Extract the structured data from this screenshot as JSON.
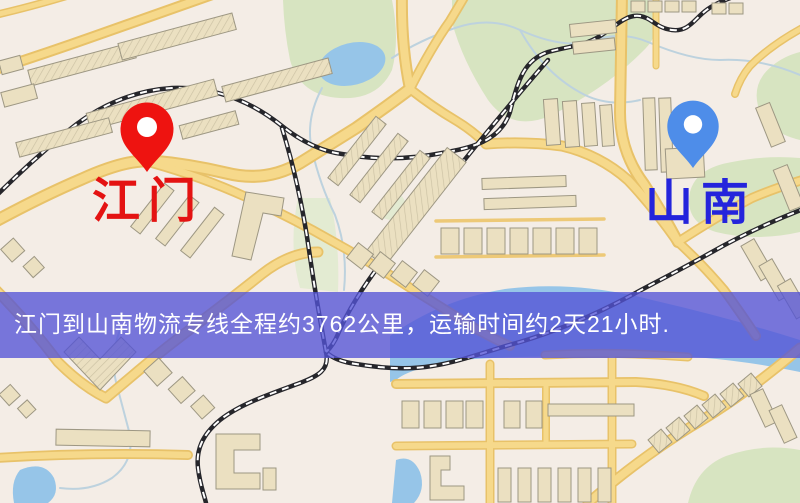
{
  "map": {
    "origin": {
      "label": "江门"
    },
    "destination": {
      "label": "山南"
    },
    "banner": {
      "text": "江门到山南物流专线全程约3762公里，运输时间约2天21小时."
    },
    "colors": {
      "bg": "#f4ede6",
      "road_fill": "#f6d98b",
      "road_casing": "#e8c269",
      "road_thin": "#edc977",
      "bldg_fill": "#ebe0c1",
      "bldg_stroke": "#9d9783",
      "park": "#d7e4c1",
      "park_soft": "#e3ebd2",
      "water": "#96c5e8",
      "stream": "#bdd2de",
      "rail": "#26262b",
      "rail_dash": "#ffffff",
      "banner_bg": "#5353d6",
      "banner_text": "#ffffff",
      "pin_red": "#ee1310",
      "label_red": "#e41312",
      "pin_blue": "#4e8de9",
      "label_blue": "#2424dc"
    }
  }
}
